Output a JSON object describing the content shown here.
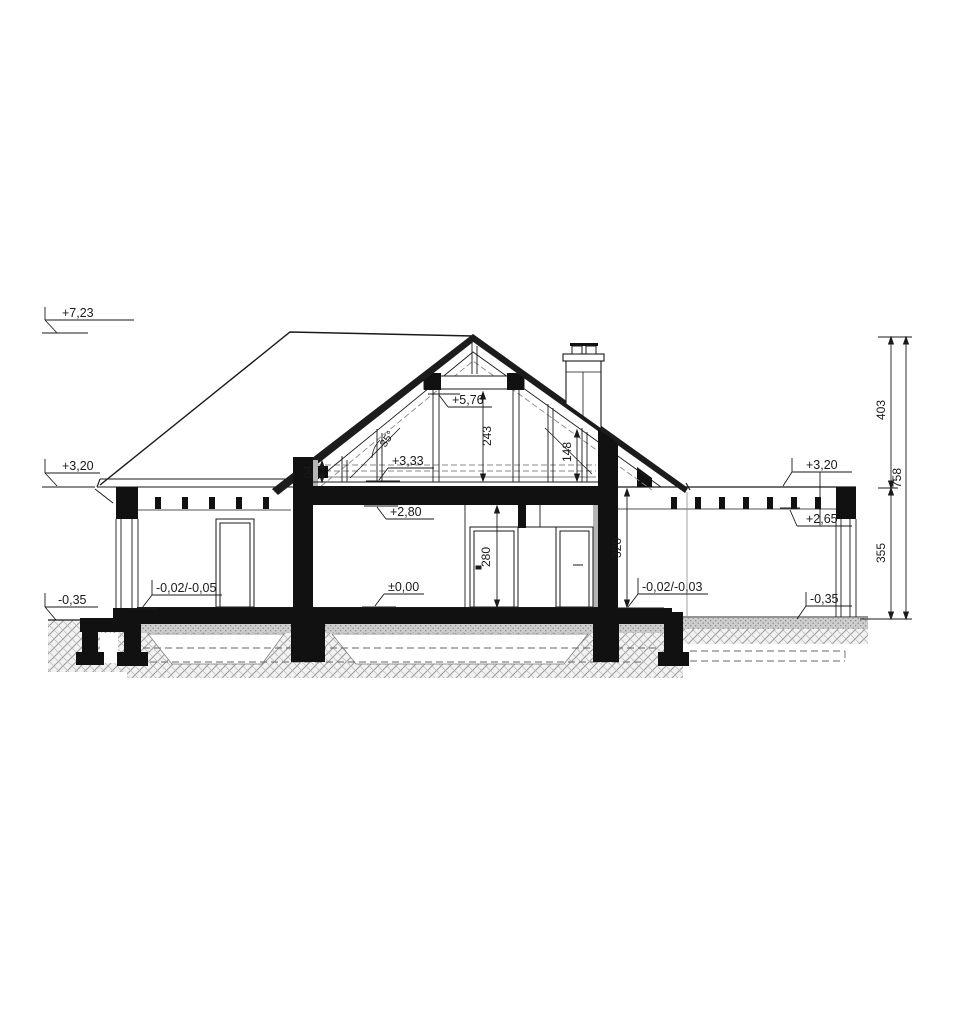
{
  "drawing": {
    "levels": {
      "ridge": "+7,23",
      "collar_beam": "+5,76",
      "attic_floor": "+3,33",
      "eaves_left": "+3,20",
      "eaves_right": "+3,20",
      "ground_ceiling": "+2,80",
      "ceiling_right": "+2,65",
      "ground_floor": "±0,00",
      "floor_left_wing": "-0,02/-0,05",
      "floor_right_wing": "-0,02/-0,03",
      "grade_left": "-0,35",
      "grade_right": "-0,35"
    },
    "dimensions": {
      "attic_clear_height": "243",
      "knee_wall_height": "64",
      "rafter_to_floor": "148",
      "door_opening_height": "280",
      "storey_height": "320",
      "roof_zone_height": "403",
      "wall_zone_height": "355",
      "total_height": "758",
      "roof_pitch": "35°"
    }
  }
}
